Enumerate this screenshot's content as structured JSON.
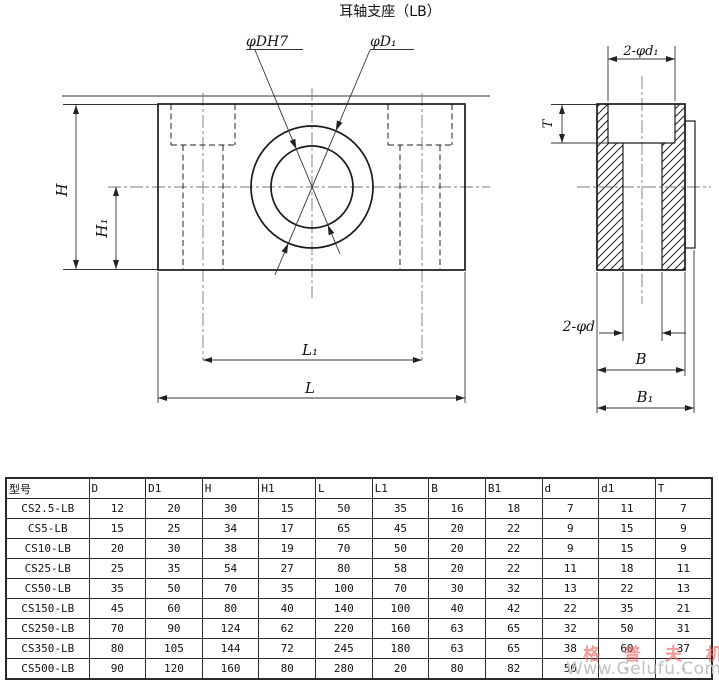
{
  "title": "耳轴支座（LB）",
  "drawing": {
    "front_view": {
      "bore_label": "φDH7",
      "outer_dia_label": "φD₁",
      "height_label": "H",
      "height1_label": "H₁",
      "length_label": "L",
      "length1_label": "L₁"
    },
    "side_view": {
      "counterbore_label": "2-φd₁",
      "hole_label": "2-φd",
      "depth_label": "T",
      "width_label": "B",
      "width1_label": "B₁"
    }
  },
  "table": {
    "headers": [
      "型号",
      "D",
      "D1",
      "H",
      "H1",
      "L",
      "L1",
      "B",
      "B1",
      "d",
      "d1",
      "T"
    ],
    "rows": [
      [
        "CS2.5-LB",
        "12",
        "20",
        "30",
        "15",
        "50",
        "35",
        "16",
        "18",
        "7",
        "11",
        "7"
      ],
      [
        "CS5-LB",
        "15",
        "25",
        "34",
        "17",
        "65",
        "45",
        "20",
        "22",
        "9",
        "15",
        "9"
      ],
      [
        "CS10-LB",
        "20",
        "30",
        "38",
        "19",
        "70",
        "50",
        "20",
        "22",
        "9",
        "15",
        "9"
      ],
      [
        "CS25-LB",
        "25",
        "35",
        "54",
        "27",
        "80",
        "58",
        "20",
        "22",
        "11",
        "18",
        "11"
      ],
      [
        "CS50-LB",
        "35",
        "50",
        "70",
        "35",
        "100",
        "70",
        "30",
        "32",
        "13",
        "22",
        "13"
      ],
      [
        "CS150-LB",
        "45",
        "60",
        "80",
        "40",
        "140",
        "100",
        "40",
        "42",
        "22",
        "35",
        "21"
      ],
      [
        "CS250-LB",
        "70",
        "90",
        "124",
        "62",
        "220",
        "160",
        "63",
        "65",
        "32",
        "50",
        "31"
      ],
      [
        "CS350-LB",
        "80",
        "105",
        "144",
        "72",
        "245",
        "180",
        "63",
        "65",
        "38",
        "60",
        "37"
      ],
      [
        "CS500-LB",
        "90",
        "120",
        "160",
        "80",
        "280",
        "20",
        "80",
        "82",
        "50",
        "-",
        "-"
      ]
    ]
  },
  "watermark": {
    "text_cn": "格 普 夫 机 械",
    "text_url": "Www.Gelufu.Com",
    "color_cn": "rgba(236,100,100,0.65)",
    "color_url": "#c0c0c0"
  }
}
